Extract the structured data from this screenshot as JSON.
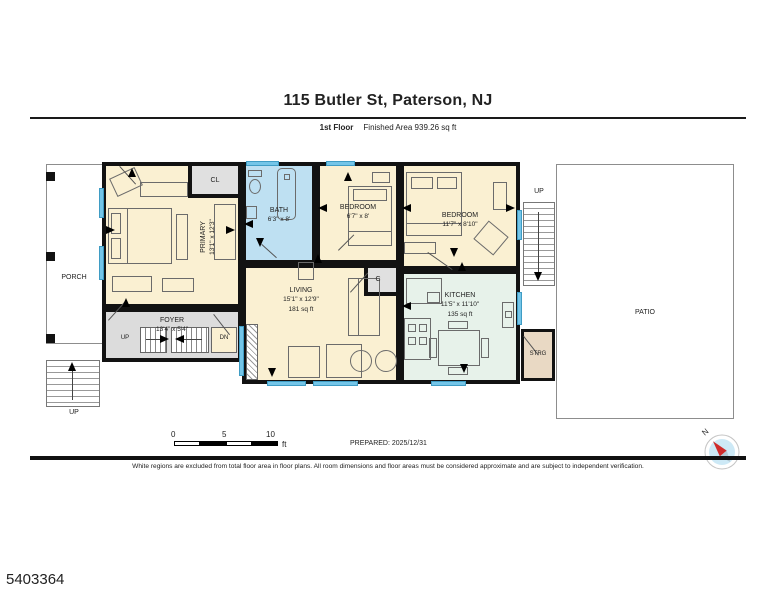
{
  "header": {
    "title": "115 Butler St, Paterson, NJ",
    "floor": "1st Floor",
    "area": "Finished Area 939.26 sq ft"
  },
  "plan": {
    "rooms": {
      "porch": {
        "name": "PORCH"
      },
      "patio": {
        "name": "PATIO"
      },
      "primary": {
        "name": "PRIMARY",
        "dims": "13'1\" x 12'3\""
      },
      "closet_cl": {
        "name": "CL"
      },
      "bath": {
        "name": "BATH",
        "dims": "6'3\" x 8'"
      },
      "bedroom_mid": {
        "name": "BEDROOM",
        "dims": "6'7\" x 8'"
      },
      "bedroom_right": {
        "name": "BEDROOM",
        "dims": "11'7\" x 8'10\""
      },
      "foyer": {
        "name": "FOYER",
        "dims": "13'4\" x 5'4\""
      },
      "living": {
        "name": "LIVING",
        "dims": "15'1\" x 12'9\"",
        "area": "181 sq ft"
      },
      "closet_c": {
        "name": "C"
      },
      "kitchen": {
        "name": "KITCHEN",
        "dims": "11'5\" x 11'10\"",
        "area": "135 sq ft"
      },
      "storage": {
        "name": "STRG"
      }
    },
    "stairs": {
      "up": "UP",
      "down": "DN"
    },
    "compass_north": "N"
  },
  "scalebar": {
    "ticks": [
      "0",
      "5",
      "10"
    ],
    "unit": "ft"
  },
  "footer": {
    "prepared": "PREPARED: 2025/12/31",
    "disclaimer": "White regions are excluded from total floor area in floor plans. All room dimensions and floor areas must be considered approximate and are subject to independent verification.",
    "id": "5403364"
  },
  "colors": {
    "wall": "#121212",
    "room_cream": "#faf0d2",
    "room_blue": "#bee0f2",
    "room_green": "#e7f2ea",
    "room_gray": "#dedede",
    "room_tan": "#e9d9c4",
    "window_blue": "#74c5e8",
    "compass_red": "#cf2b2b",
    "compass_fill": "#cde9f6"
  }
}
